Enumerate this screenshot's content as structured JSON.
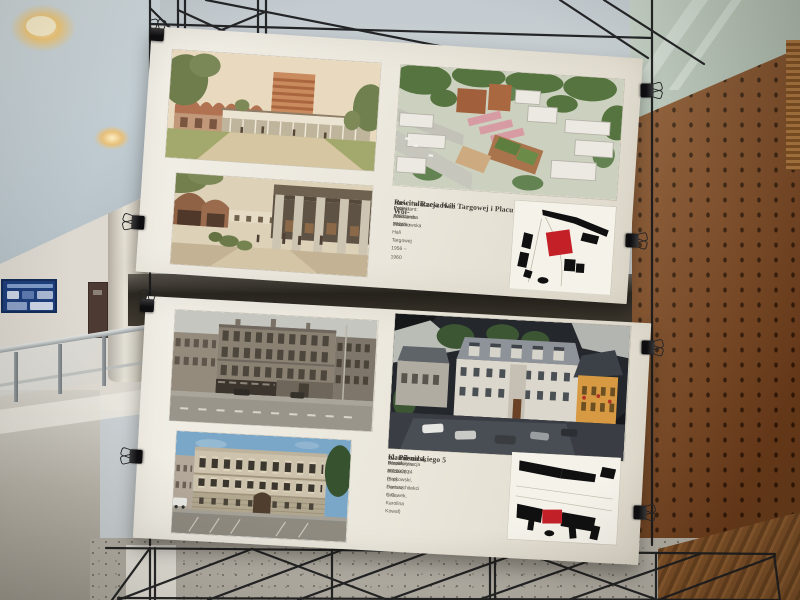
{
  "posters": {
    "top": {
      "title_line1": "Rewitalizacja Hali Targowej i Placu Wol-",
      "title_line2": "ności w Rzeszowie",
      "credits": [
        "Projektant: Aleksandra Wasilkowska",
        "Projekt: 2023 – 2024",
        "Lata powstania zespołu Hali Targowej 1956 – 1960"
      ]
    },
    "bottom": {
      "title_line1": "Kamienica,",
      "title_line2": "ul. Piłsudskiego 5",
      "credits": [
        "Rewaloryzacja 2020–2024 (proj. Formarchitekci S.C.,",
        "zespół: Miłosz Piątkowski, Dariusz Gniewek, Karolina Kowal)",
        "Wzniesiona ok. 1908 r."
      ]
    }
  },
  "colors": {
    "poster_paper": "#ece8dd",
    "plan_accent_red": "#c32028",
    "plan_black": "#111111",
    "perforated_panel_rust": "#7c4a25",
    "truss_black": "#1a1b1d",
    "interior_wall": "#ccd4d8",
    "terrazzo_floor": "#b2aea4",
    "notice_board_blue": "#1d3e7c"
  }
}
